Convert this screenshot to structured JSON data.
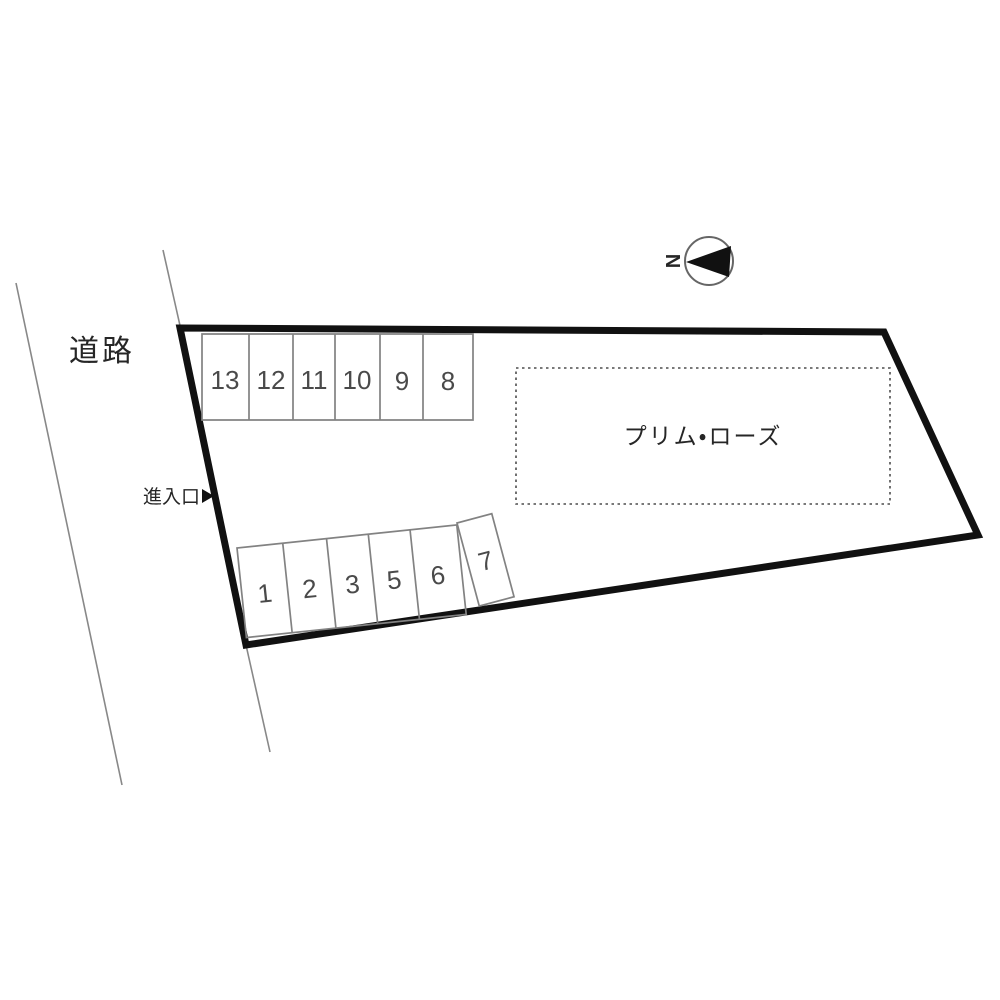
{
  "diagram": {
    "road_label": "道路",
    "entrance_label": "進入口",
    "building_name": "プリム・ローズ",
    "compass_letter": "N",
    "top_row_stalls": [
      "13",
      "12",
      "11",
      "10",
      "9",
      "8"
    ],
    "bottom_row_stalls": [
      "1",
      "2",
      "3",
      "5",
      "6"
    ],
    "separate_stall": "7",
    "icons": {
      "entrance_arrow": "▶",
      "north_arrow": "◀"
    },
    "colors": {
      "ink": "#111111",
      "thin_line": "#888888",
      "stall_line": "#828282",
      "dashed_line": "#4d4d4d",
      "number_text": "#4a4a4a",
      "label_text": "#262626",
      "compass_line": "#666666",
      "bg": "#ffffff"
    }
  }
}
